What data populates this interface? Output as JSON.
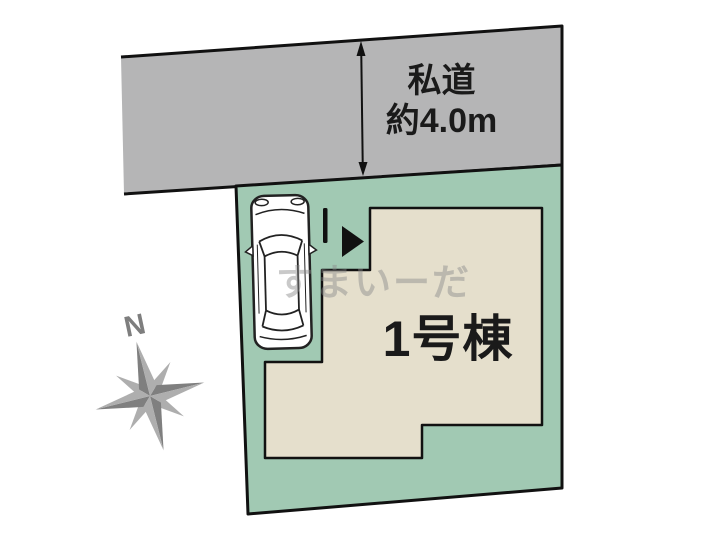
{
  "plan_type": "site-plan",
  "road": {
    "name": "私道",
    "width_note": "約4.0m"
  },
  "plot": {
    "building_label": "1号棟"
  },
  "compass": {
    "north_label": "N"
  },
  "watermark": {
    "text": "すまいーだ"
  },
  "colors": {
    "background": "#ffffff",
    "road_fill": "#b5b5b6",
    "plot_fill": "#a1c9b3",
    "building_fill": "#e5dfcc",
    "outline": "#111111",
    "label_text": "#1a1a1a",
    "compass_dark": "#7f7f7f",
    "compass_light": "#aeaeae",
    "marker_black": "#111111",
    "car_fill": "#ffffff",
    "car_stroke": "#222222",
    "watermark_color": "#8a8a8a"
  },
  "icons": {
    "compass": "compass-rose-icon",
    "entrance_arrow": "entrance-arrow-icon",
    "dimension_arrow": "dimension-arrow-icon",
    "car": "car-top-view-icon"
  }
}
